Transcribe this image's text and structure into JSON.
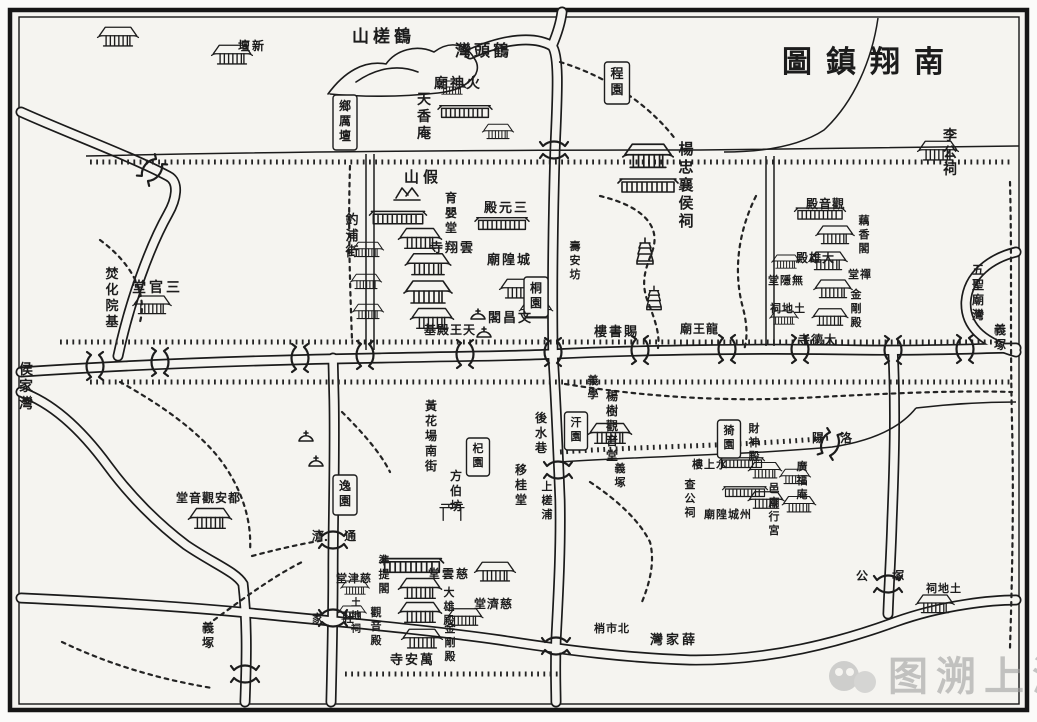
{
  "title": {
    "text": "圖鎮翔南"
  },
  "watermark": {
    "text": "图溯上海"
  },
  "colors": {
    "ink": "#1c1c1c",
    "paper": "#f5f4f0",
    "watermark": "#a0a0a0"
  },
  "map": {
    "labels": [
      {
        "text": "圖鎮翔南",
        "x": 782,
        "y": 72,
        "dir": "h",
        "size": 30,
        "ls": 14
      },
      {
        "text": "山槎鶴",
        "x": 352,
        "y": 42,
        "dir": "h",
        "size": 17,
        "ls": 4
      },
      {
        "text": "灣頭鶴",
        "x": 455,
        "y": 56,
        "dir": "h",
        "size": 16,
        "ls": 3
      },
      {
        "text": "廟神火",
        "x": 434,
        "y": 88,
        "dir": "h",
        "size": 14,
        "ls": 2
      },
      {
        "text": "天香庵",
        "x": 424,
        "y": 104,
        "dir": "v",
        "size": 14
      },
      {
        "text": "壇新",
        "x": 238,
        "y": 50,
        "dir": "h",
        "size": 12,
        "ls": 2
      },
      {
        "text": "鄉厲壇",
        "x": 345,
        "y": 110,
        "dir": "v",
        "size": 12,
        "boxed": true
      },
      {
        "text": "程園",
        "x": 617,
        "y": 78,
        "dir": "v",
        "size": 13,
        "boxed": true
      },
      {
        "text": "李公祠",
        "x": 950,
        "y": 140,
        "dir": "v",
        "size": 14
      },
      {
        "text": "楊忠襄侯祠",
        "x": 686,
        "y": 154,
        "dir": "v",
        "size": 15
      },
      {
        "text": "山假",
        "x": 404,
        "y": 182,
        "dir": "h",
        "size": 15,
        "ls": 4
      },
      {
        "text": "殿元三",
        "x": 484,
        "y": 212,
        "dir": "h",
        "size": 13,
        "ls": 2
      },
      {
        "text": "育嬰堂",
        "x": 451,
        "y": 202,
        "dir": "v",
        "size": 12
      },
      {
        "text": "寺翔雲",
        "x": 430,
        "y": 252,
        "dir": "h",
        "size": 13,
        "ls": 2
      },
      {
        "text": "廟隍城",
        "x": 487,
        "y": 264,
        "dir": "h",
        "size": 13,
        "ls": 2
      },
      {
        "text": "桐園",
        "x": 536,
        "y": 292,
        "dir": "v",
        "size": 12,
        "boxed": true
      },
      {
        "text": "閣昌文",
        "x": 488,
        "y": 322,
        "dir": "h",
        "size": 13,
        "ls": 2
      },
      {
        "text": "基殿王天",
        "x": 424,
        "y": 334,
        "dir": "h",
        "size": 12,
        "ls": 1
      },
      {
        "text": "釣浦街",
        "x": 352,
        "y": 224,
        "dir": "v",
        "size": 13
      },
      {
        "text": "壽安坊",
        "x": 575,
        "y": 250,
        "dir": "v",
        "size": 11
      },
      {
        "text": "堂官三",
        "x": 132,
        "y": 292,
        "dir": "h",
        "size": 14,
        "ls": 3
      },
      {
        "text": "焚化院基",
        "x": 112,
        "y": 278,
        "dir": "v",
        "size": 13
      },
      {
        "text": "侯家灣",
        "x": 26,
        "y": 374,
        "dir": "v",
        "size": 14
      },
      {
        "text": "樓書賜",
        "x": 594,
        "y": 336,
        "dir": "h",
        "size": 13,
        "ls": 2
      },
      {
        "text": "廟王龍",
        "x": 680,
        "y": 333,
        "dir": "h",
        "size": 12,
        "ls": 1
      },
      {
        "text": "殿音觀",
        "x": 806,
        "y": 208,
        "dir": "h",
        "size": 12,
        "ls": 1
      },
      {
        "text": "藕香閣",
        "x": 864,
        "y": 224,
        "dir": "v",
        "size": 11
      },
      {
        "text": "殿雄大",
        "x": 796,
        "y": 262,
        "dir": "h",
        "size": 12,
        "ls": 1
      },
      {
        "text": "堂禪",
        "x": 848,
        "y": 278,
        "dir": "h",
        "size": 11,
        "ls": 1
      },
      {
        "text": "金剛殿",
        "x": 856,
        "y": 298,
        "dir": "v",
        "size": 11
      },
      {
        "text": "堂隱無",
        "x": 768,
        "y": 284,
        "dir": "h",
        "size": 11,
        "ls": 1
      },
      {
        "text": "祠地土",
        "x": 770,
        "y": 312,
        "dir": "h",
        "size": 11,
        "ls": 1
      },
      {
        "text": "寺德大",
        "x": 798,
        "y": 344,
        "dir": "h",
        "size": 12,
        "ls": 1
      },
      {
        "text": "五聖廟灣",
        "x": 978,
        "y": 274,
        "dir": "v",
        "size": 12
      },
      {
        "text": "義塚",
        "x": 1000,
        "y": 334,
        "dir": "v",
        "size": 12
      },
      {
        "text": "後水巷",
        "x": 541,
        "y": 422,
        "dir": "v",
        "size": 12
      },
      {
        "text": "黃花場南街",
        "x": 431,
        "y": 410,
        "dir": "v",
        "size": 12
      },
      {
        "text": "逸園",
        "x": 345,
        "y": 490,
        "dir": "v",
        "size": 12,
        "boxed": true
      },
      {
        "text": "方伯坊",
        "x": 456,
        "y": 480,
        "dir": "v",
        "size": 12
      },
      {
        "text": "杞園",
        "x": 478,
        "y": 452,
        "dir": "v",
        "size": 11,
        "boxed": true
      },
      {
        "text": "移桂堂",
        "x": 521,
        "y": 474,
        "dir": "v",
        "size": 12
      },
      {
        "text": "義學",
        "x": 593,
        "y": 384,
        "dir": "v",
        "size": 11
      },
      {
        "text": "汗園",
        "x": 576,
        "y": 426,
        "dir": "v",
        "size": 11,
        "boxed": true
      },
      {
        "text": "楊樹觀音堂",
        "x": 612,
        "y": 400,
        "dir": "v",
        "size": 12
      },
      {
        "text": "猗園",
        "x": 729,
        "y": 434,
        "dir": "v",
        "size": 11,
        "boxed": true
      },
      {
        "text": "財神殿",
        "x": 754,
        "y": 432,
        "dir": "v",
        "size": 11
      },
      {
        "text": "樓上水",
        "x": 692,
        "y": 468,
        "dir": "h",
        "size": 11,
        "ls": 1
      },
      {
        "text": "查公祠",
        "x": 690,
        "y": 488,
        "dir": "v",
        "size": 11
      },
      {
        "text": "廟隍城州",
        "x": 704,
        "y": 518,
        "dir": "h",
        "size": 11,
        "ls": 1
      },
      {
        "text": "邑廟行宮",
        "x": 774,
        "y": 492,
        "dir": "v",
        "size": 11
      },
      {
        "text": "廣福庵",
        "x": 802,
        "y": 470,
        "dir": "v",
        "size": 11
      },
      {
        "text": "陽 洛",
        "x": 812,
        "y": 442,
        "dir": "h",
        "size": 12,
        "ls": 6
      },
      {
        "text": "義塚",
        "x": 620,
        "y": 472,
        "dir": "v",
        "size": 11
      },
      {
        "text": "濟 通",
        "x": 312,
        "y": 540,
        "dir": "h",
        "size": 12,
        "ls": 8
      },
      {
        "text": "家 杜",
        "x": 312,
        "y": 622,
        "dir": "h",
        "size": 11,
        "ls": 8
      },
      {
        "text": "堂音觀安都",
        "x": 176,
        "y": 502,
        "dir": "h",
        "size": 12,
        "ls": 1
      },
      {
        "text": "義塚",
        "x": 208,
        "y": 632,
        "dir": "v",
        "size": 12
      },
      {
        "text": "堂雲慈",
        "x": 428,
        "y": 578,
        "dir": "h",
        "size": 12,
        "ls": 2
      },
      {
        "text": "準提閣",
        "x": 384,
        "y": 564,
        "dir": "v",
        "size": 11
      },
      {
        "text": "堂津慈",
        "x": 336,
        "y": 582,
        "dir": "h",
        "size": 11,
        "ls": 1
      },
      {
        "text": "大雄殿",
        "x": 449,
        "y": 596,
        "dir": "v",
        "size": 11
      },
      {
        "text": "堂濟慈",
        "x": 474,
        "y": 608,
        "dir": "h",
        "size": 12,
        "ls": 1
      },
      {
        "text": "土地祠",
        "x": 356,
        "y": 606,
        "dir": "v",
        "size": 10
      },
      {
        "text": "觀音殿",
        "x": 376,
        "y": 616,
        "dir": "v",
        "size": 11
      },
      {
        "text": "金剛殿",
        "x": 450,
        "y": 632,
        "dir": "v",
        "size": 11
      },
      {
        "text": "寺安萬",
        "x": 390,
        "y": 664,
        "dir": "h",
        "size": 13,
        "ls": 2
      },
      {
        "text": "上槎浦",
        "x": 547,
        "y": 490,
        "dir": "v",
        "size": 11
      },
      {
        "text": "公 塚",
        "x": 856,
        "y": 580,
        "dir": "h",
        "size": 12,
        "ls": 10
      },
      {
        "text": "祠地土",
        "x": 926,
        "y": 592,
        "dir": "h",
        "size": 11,
        "ls": 1
      },
      {
        "text": "灣家薛",
        "x": 650,
        "y": 644,
        "dir": "h",
        "size": 13,
        "ls": 3
      },
      {
        "text": "梢市北",
        "x": 594,
        "y": 632,
        "dir": "h",
        "size": 11,
        "ls": 1
      }
    ]
  }
}
